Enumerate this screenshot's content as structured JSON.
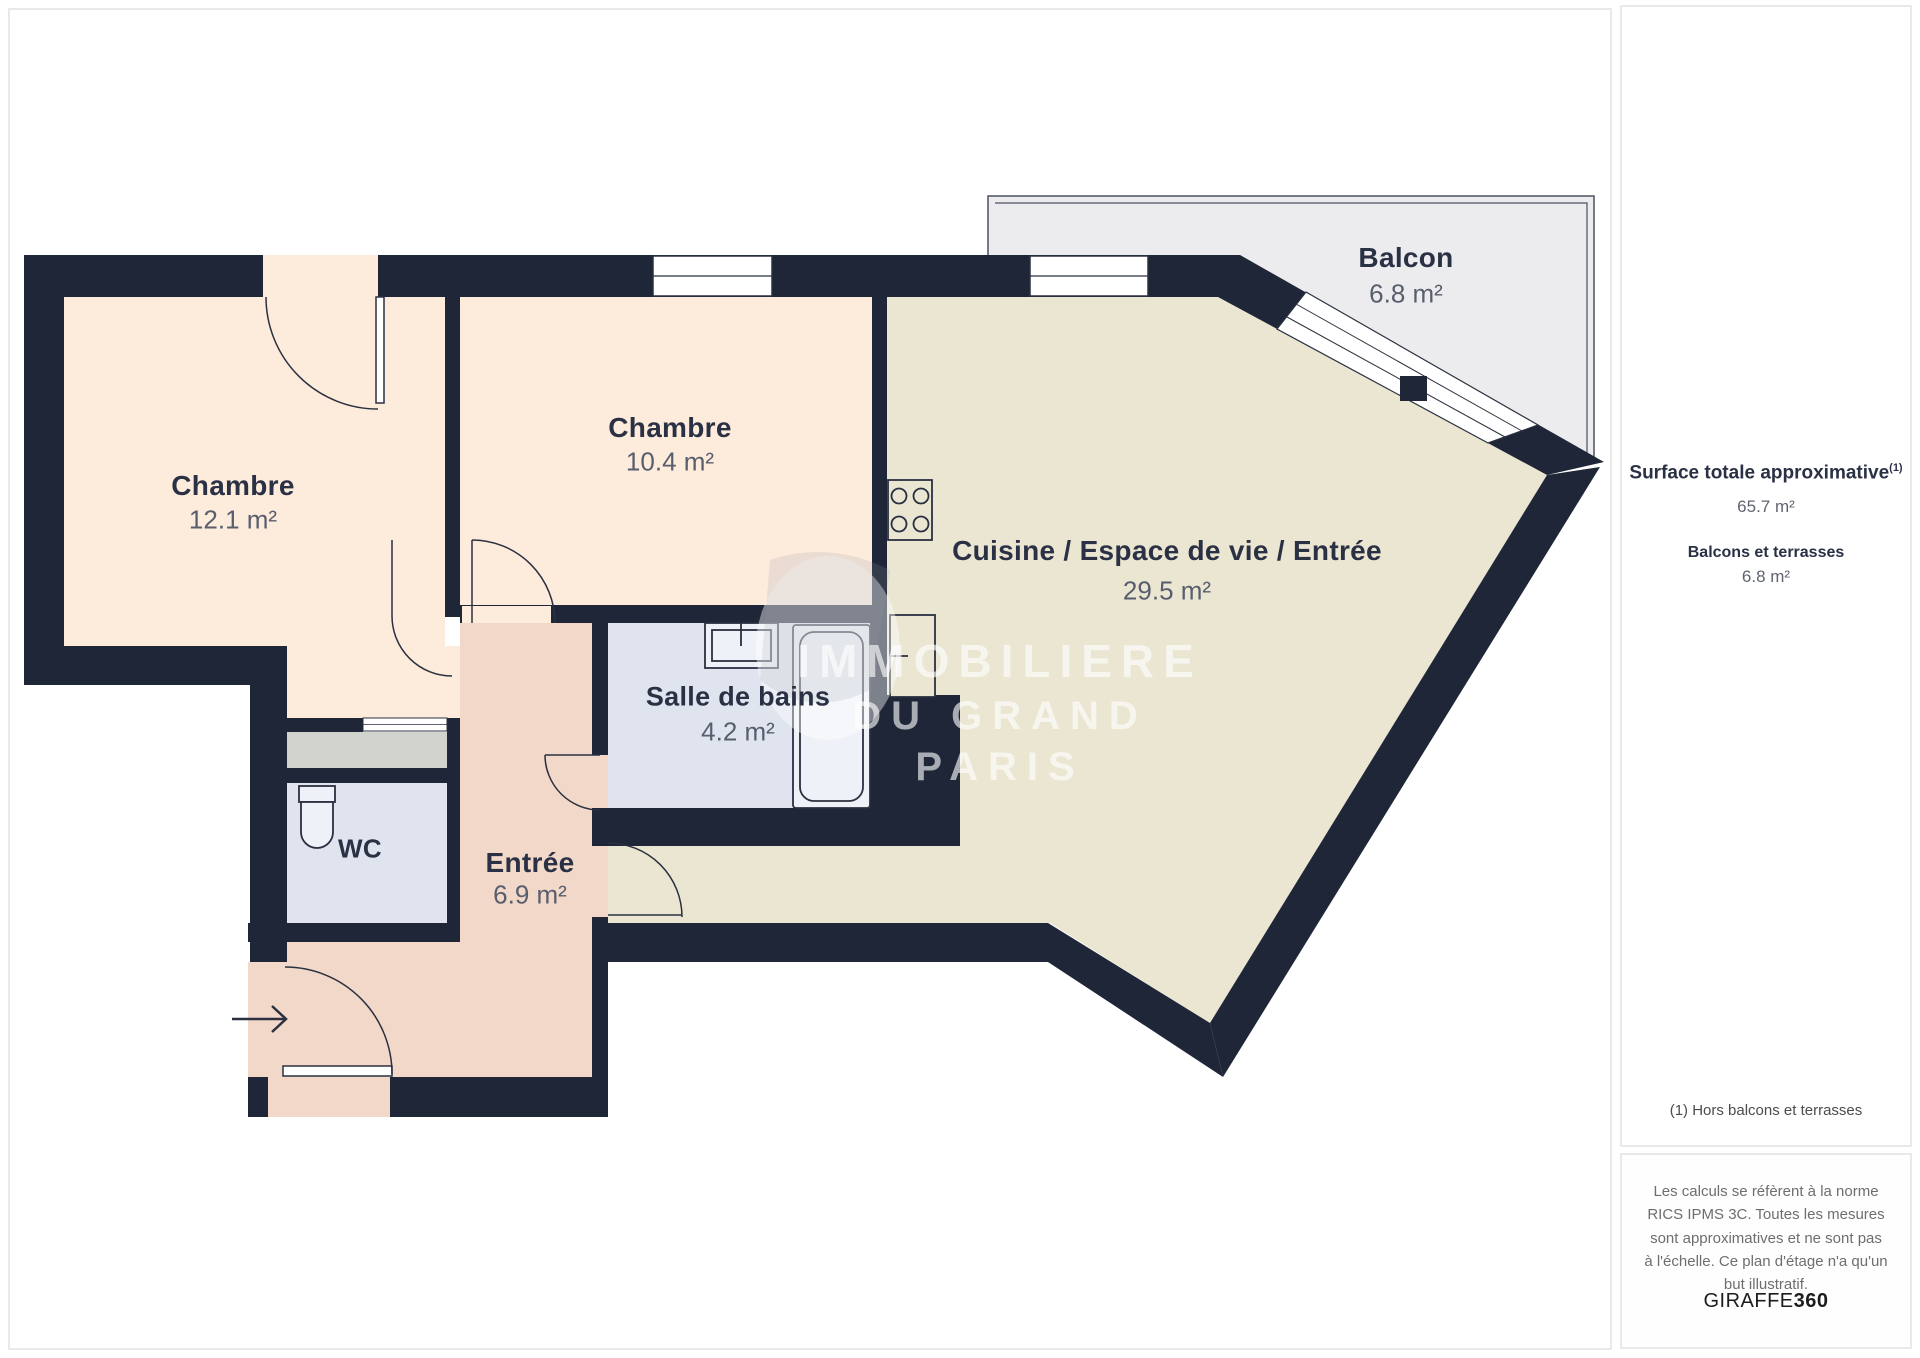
{
  "plan": {
    "rooms": [
      {
        "id": "chambre-1",
        "name": "Chambre",
        "area": "12.1 m²"
      },
      {
        "id": "chambre-2",
        "name": "Chambre",
        "area": "10.4 m²"
      },
      {
        "id": "cuisine-espace-de-vie-entree",
        "name": "Cuisine / Espace de vie / Entrée",
        "area": "29.5 m²"
      },
      {
        "id": "salle-de-bains",
        "name": "Salle de bains",
        "area": "4.2 m²"
      },
      {
        "id": "wc",
        "name": "WC",
        "area": ""
      },
      {
        "id": "entree",
        "name": "Entrée",
        "area": "6.9 m²"
      },
      {
        "id": "balcon",
        "name": "Balcon",
        "area": "6.8 m²"
      }
    ],
    "colors": {
      "wall": "#1f2637",
      "bedroom_fill": "#fdebdc",
      "living_fill": "#eae6d2",
      "hall_fill": "#f2d8c8",
      "bath_fill": "#e0e4ef",
      "closet_fill": "#d2d3ce",
      "balcony_fill": "#ececee",
      "label_text": "#2b3144"
    }
  },
  "watermark": {
    "line1": "IMMOBILIERE",
    "line2": "DU GRAND",
    "line3": "PARIS"
  },
  "sidebar": {
    "surface_title": "Surface totale approximative",
    "surface_note_ref": "(1)",
    "surface_value": "65.7 m²",
    "balconies_title": "Balcons et terrasses",
    "balconies_value": "6.8 m²",
    "footnote": "(1) Hors balcons et terrasses",
    "disclaimer": "Les calculs se réfèrent à la norme RICS IPMS 3C. Toutes les mesures sont approximatives et ne sont pas à l'échelle. Ce plan d'étage n'a qu'un but illustratif.",
    "brand_name": "GIRAFFE",
    "brand_number": "360"
  }
}
